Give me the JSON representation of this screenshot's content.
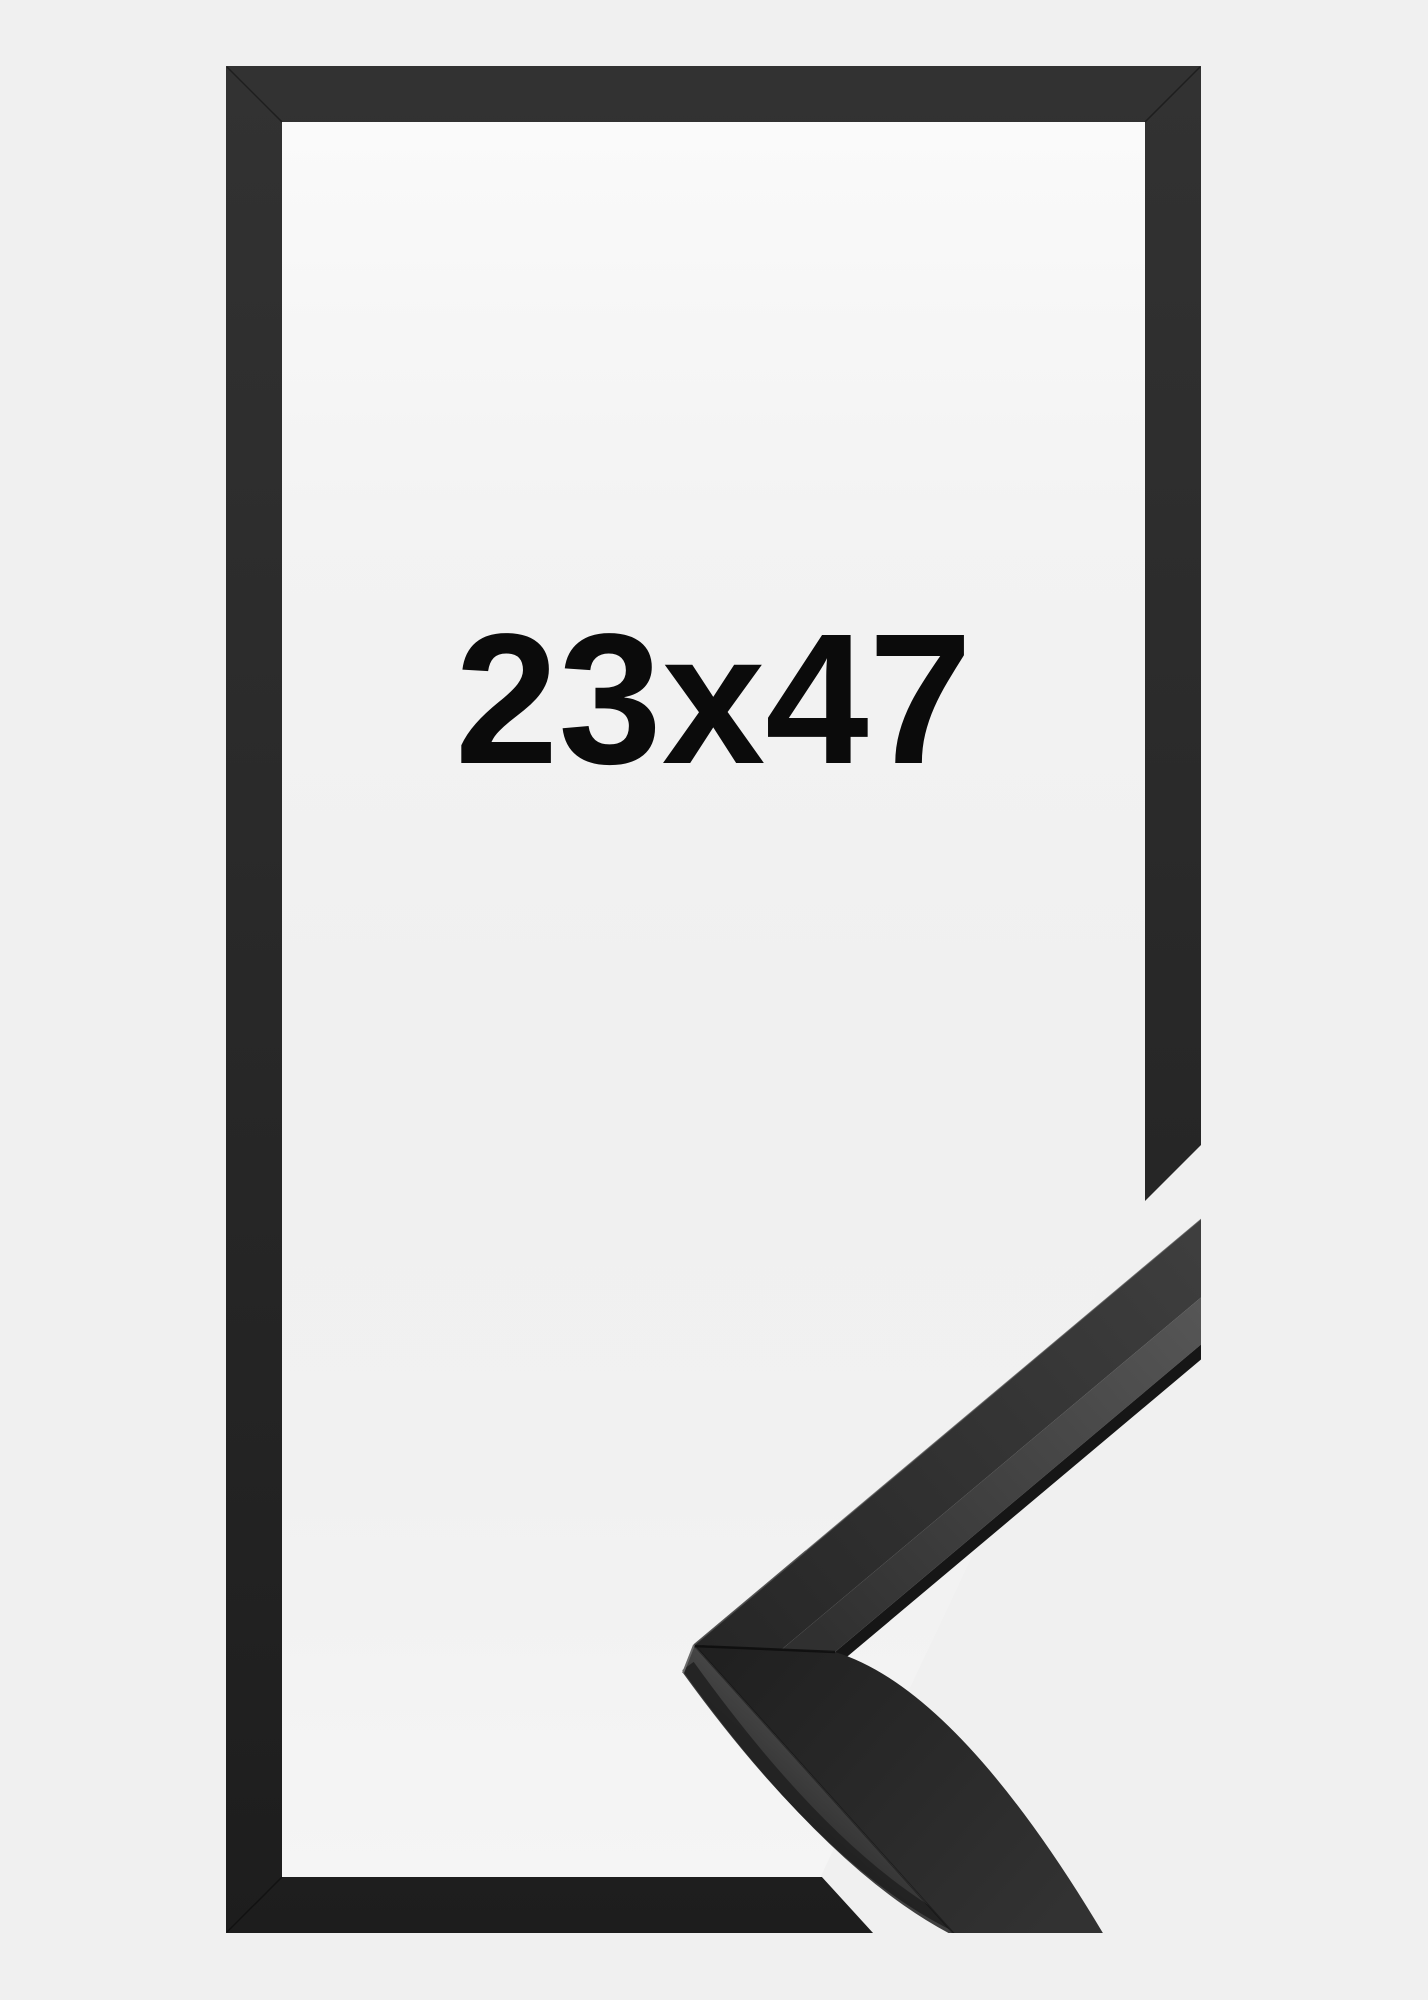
{
  "product_image": {
    "size_label": "23x47",
    "colors": {
      "background": "#f0f0f0",
      "frame_moulding": "#2a2a2a",
      "interior": "#f5f5f5",
      "label_text": "#0b0b0b"
    }
  }
}
